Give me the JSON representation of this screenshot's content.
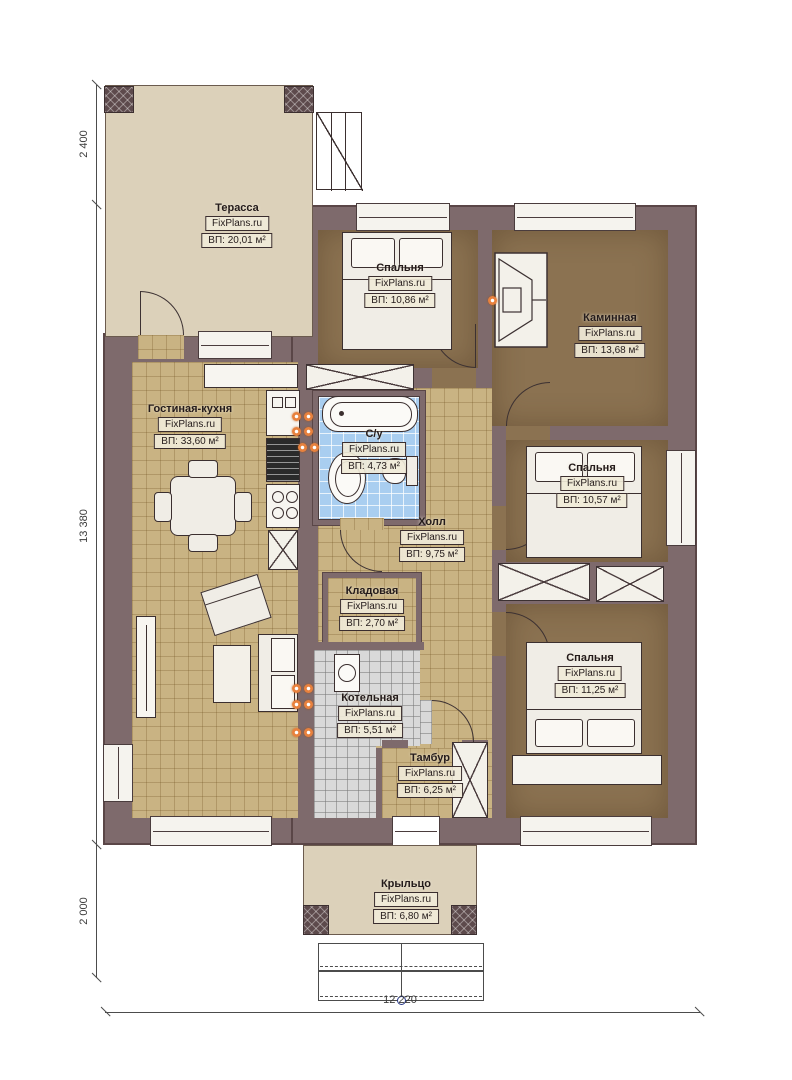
{
  "plan": {
    "title": "Floor plan of a single-storey house",
    "brand": "FixPlans.ru",
    "rooms": [
      {
        "id": "terrace",
        "name": "Терасса",
        "area": "ВП: 20,01 м²"
      },
      {
        "id": "bedroom1",
        "name": "Спальня",
        "area": "ВП: 10,86 м²"
      },
      {
        "id": "fireplace",
        "name": "Каминная",
        "area": "ВП: 13,68 м²"
      },
      {
        "id": "living",
        "name": "Гостиная-кухня",
        "area": "ВП: 33,60 м²"
      },
      {
        "id": "bathroom",
        "name": "С/у",
        "area": "ВП: 4,73 м²"
      },
      {
        "id": "hall",
        "name": "Холл",
        "area": "ВП: 9,75 м²"
      },
      {
        "id": "bedroom2",
        "name": "Спальня",
        "area": "ВП: 10,57 м²"
      },
      {
        "id": "pantry",
        "name": "Кладовая",
        "area": "ВП: 2,70 м²"
      },
      {
        "id": "boiler",
        "name": "Котельная",
        "area": "ВП: 5,51 м²"
      },
      {
        "id": "bedroom3",
        "name": "Спальня",
        "area": "ВП: 11,25 м²"
      },
      {
        "id": "vestibule",
        "name": "Тамбур",
        "area": "ВП: 6,25 м²"
      },
      {
        "id": "porch",
        "name": "Крыльцо",
        "area": "ВП: 6,80 м²"
      }
    ],
    "dimensions": {
      "left_top": "2 400",
      "left_middle": "13 380",
      "left_bottom": "2 000",
      "bottom": "12 220"
    },
    "colors": {
      "wall": "#7e6a6c",
      "wall_edge": "#5a4647",
      "terrace_floor": "#dcd1ba",
      "bedroom_floor": "#8b7251",
      "living_floor": "#c9b383",
      "bathroom_floor": "#a9cef0",
      "boiler_floor": "#d9d9d9",
      "label_bg": "#f0ead8",
      "supply_marker": "#e8813d"
    }
  }
}
